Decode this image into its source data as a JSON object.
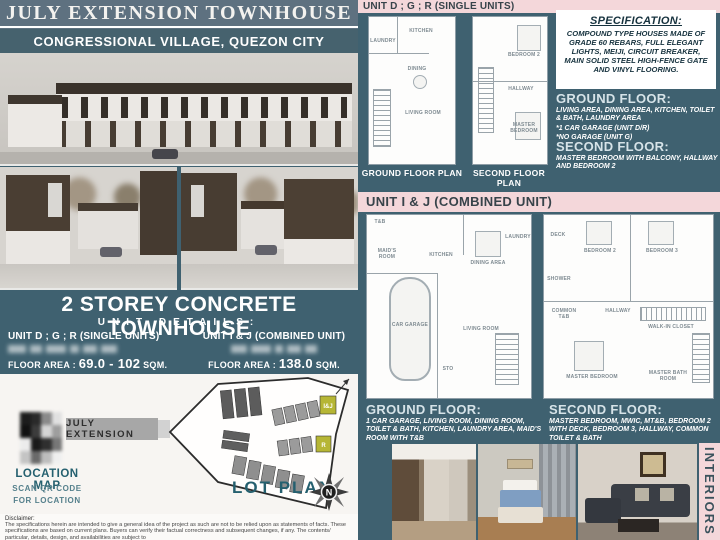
{
  "header": {
    "title": "JULY EXTENSION TOWNHOUSE",
    "subtitle": "CONGRESSIONAL VILLAGE, QUEZON CITY"
  },
  "unit_details": {
    "heading": "2 STOREY CONCRETE TOWNHOUSE",
    "subheading": "UNIT DETAILS:",
    "single": {
      "title": "UNIT D ; G ; R (SINGLE UNITS)",
      "floor_area_label": "FLOOR AREA :",
      "floor_area_value": "69.0 - 102",
      "floor_area_unit": "SQM."
    },
    "combined": {
      "title": "UNIT I & J (COMBINED UNIT)",
      "floor_area_label": "FLOOR AREA :",
      "floor_area_value": "138.0",
      "floor_area_unit": "SQM."
    }
  },
  "map_section": {
    "road_label": "JULY EXTENSION",
    "location_map_label": "LOCATION MAP",
    "scan_line1": "SCAN QR CODE",
    "scan_line2": "FOR LOCATION",
    "lot_plan_label": "LOT PLAN",
    "unit_ij_tag": "I&J",
    "unit_r_tag": "R",
    "compass_north": "N"
  },
  "disclaimer": {
    "label": "Disclaimer:",
    "text": "The specifications herein are intended to give a general idea of the project as such are not to be relied upon as statements of facts. These specifications are based on current plans. Buyers can verify their factual correctness and subsequent changes, if any. The contents/ particular, details, design, and availabilities are subject to"
  },
  "single_unit": {
    "header": "UNIT D ; G ; R (SINGLE UNITS)",
    "ground_plan_label": "GROUND FLOOR PLAN",
    "second_plan_label": "SECOND FLOOR PLAN",
    "ground_rooms": [
      "LAUNDRY",
      "KITCHEN",
      "DINING",
      "LIVING ROOM"
    ],
    "second_rooms": [
      "BEDROOM 2",
      "HALLWAY",
      "MASTER BEDROOM"
    ],
    "specification_title": "SPECIFICATION:",
    "specification_body": "COMPOUND TYPE HOUSES MADE OF GRADE 60 REBARS, FULL ELEGANT LIGHTS, MEIJI, CIRCUIT BREAKER, MAIN SOLID STEEL HIGH-FENCE GATE AND VINYL FLOORING.",
    "ground_floor_title": "GROUND FLOOR:",
    "ground_floor_line1": "LIVING AREA, DINING AREA, KITCHEN, TOILET & BATH, LAUNDRY AREA",
    "ground_floor_line2": "*1 CAR GARAGE (UNIT D/R)",
    "ground_floor_line3": "*NO GARAGE (UNIT G)",
    "second_floor_title": "SECOND FLOOR:",
    "second_floor_line1": "MASTER BEDROOM WITH BALCONY, HALLWAY AND BEDROOM 2"
  },
  "combined_unit": {
    "header": "UNIT I & J (COMBINED UNIT)",
    "ground_rooms": [
      "T&B",
      "MAID'S ROOM",
      "KITCHEN",
      "DINING AREA",
      "LAUNDRY",
      "CAR GARAGE",
      "LIVING ROOM",
      "STO"
    ],
    "second_rooms": [
      "DECK",
      "BEDROOM 2",
      "BEDROOM 3",
      "SHOWER",
      "COMMON T&B",
      "HALLWAY",
      "WALK-IN CLOSET",
      "MASTER BEDROOM",
      "MASTER BATH ROOM"
    ],
    "ground_floor_title": "GROUND FLOOR:",
    "ground_floor_body": "1 CAR GARAGE, LIVING ROOM, DINING ROOM, TOILET & BATH, KITCHEN, LAUNDRY AREA, MAID'S ROOM WITH T&B",
    "second_floor_title": "SECOND FLOOR:",
    "second_floor_body": "MASTER BEDROOM, MWIC, MT&B, BEDROOM 2 WITH DECK, BEDROOM 3, HALLWAY, COMMON TOILET & BATH"
  },
  "interiors_label": "INTERIORS",
  "colors": {
    "panel_teal": "#3f6170",
    "strip_pink": "#f4d7da",
    "header_slate": "#5e7180",
    "subtitle_teal": "#46626e",
    "accent_teal_text": "#25606f",
    "lot_highlight_yellow": "#b6b635"
  }
}
